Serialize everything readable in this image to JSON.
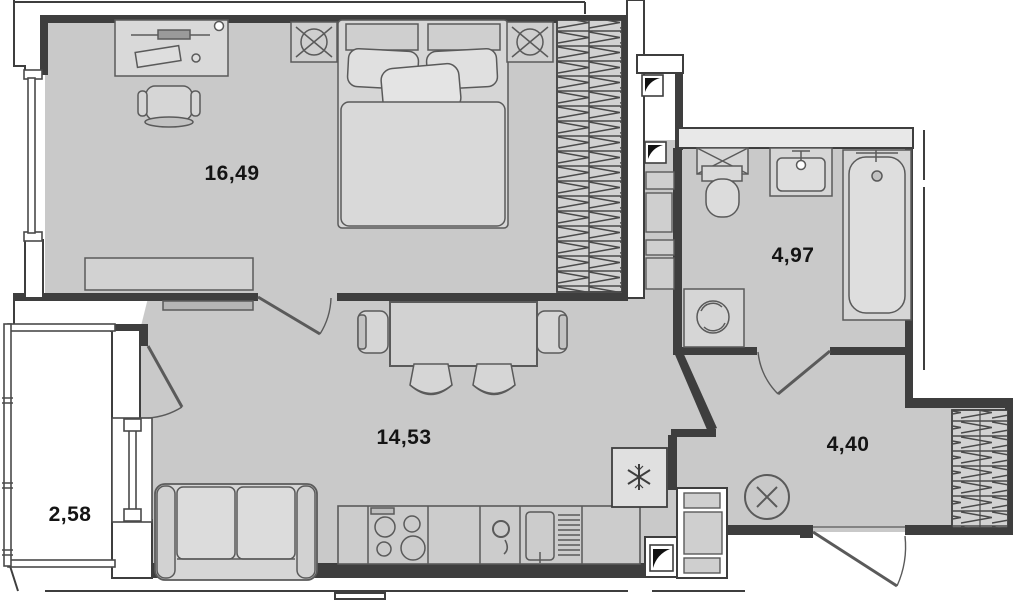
{
  "floorplan": {
    "title": "apartment-floor-plan",
    "rooms": [
      {
        "name": "bedroom",
        "area_label": "16,49"
      },
      {
        "name": "bathroom",
        "area_label": "4,97"
      },
      {
        "name": "living-kitchen",
        "area_label": "14,53"
      },
      {
        "name": "hallway",
        "area_label": "4,40"
      },
      {
        "name": "balcony",
        "area_label": "2,58"
      }
    ],
    "colors": {
      "floor": "#c9c9c9",
      "wall": "#3e3e3e",
      "furniture_line": "#5a5a5a",
      "furniture_fill": "#d6d6d6",
      "background": "#ffffff"
    },
    "furniture": [
      "desk",
      "desk-lamp",
      "office-chair",
      "double-bed",
      "pillows",
      "nightstand-left",
      "nightstand-right",
      "built-in-wardrobe",
      "low-cabinet",
      "tv-console",
      "dining-table",
      "dining-chairs",
      "sofa",
      "kitchen-counter",
      "stove",
      "kitchen-sink",
      "dish-dryer",
      "fridge",
      "vent-shaft",
      "service-cabinet",
      "ceiling-lamp",
      "washing-machine",
      "vent-grille",
      "toilet",
      "wash-basin",
      "bathtub",
      "hall-wardrobe",
      "entrance-door",
      "balcony-door",
      "bedroom-door",
      "bathroom-door",
      "windows"
    ]
  }
}
